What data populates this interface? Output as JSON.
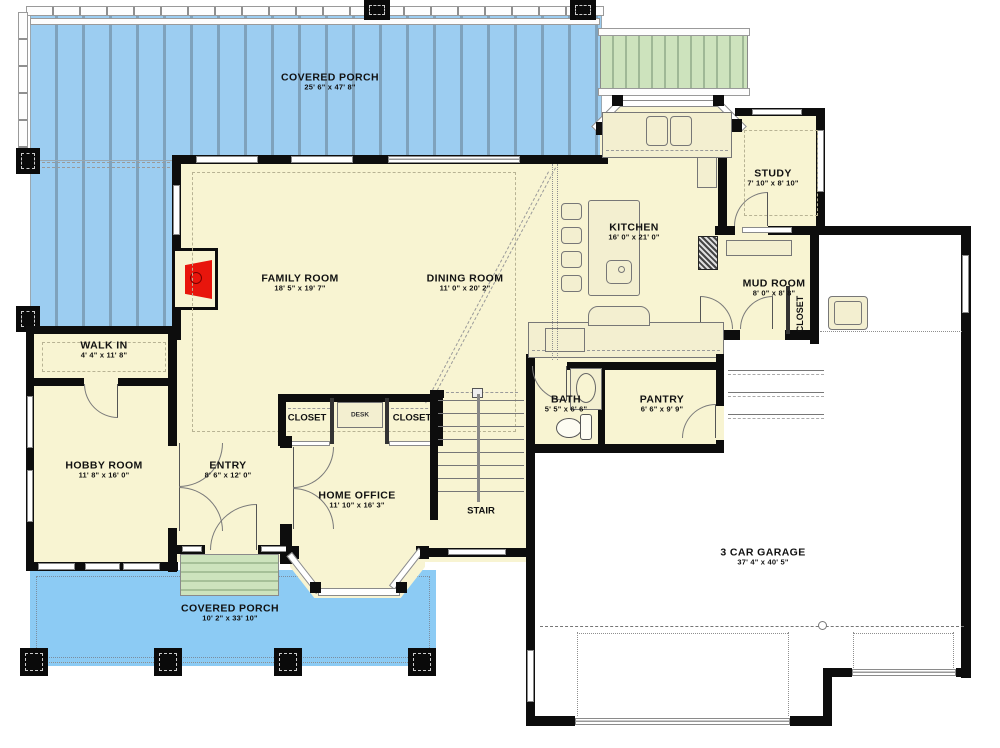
{
  "plan": {
    "title": "First floor plan",
    "rooms": [
      {
        "id": "covered-porch-top",
        "name": "COVERED PORCH",
        "dims": "25' 6\" x 47' 8\""
      },
      {
        "id": "study",
        "name": "STUDY",
        "dims": "7' 10\" x 8' 10\""
      },
      {
        "id": "kitchen",
        "name": "KITCHEN",
        "dims": "16' 0\" x 21' 0\""
      },
      {
        "id": "family-room",
        "name": "FAMILY ROOM",
        "dims": "18' 5\" x 19' 7\""
      },
      {
        "id": "dining-room",
        "name": "DINING ROOM",
        "dims": "11' 0\" x 20' 2\""
      },
      {
        "id": "mud-room",
        "name": "MUD ROOM",
        "dims": "8' 0\" x 8' 8\""
      },
      {
        "id": "walk-in",
        "name": "WALK IN",
        "dims": "4' 4\" x 11' 8\""
      },
      {
        "id": "hobby-room",
        "name": "HOBBY ROOM",
        "dims": "11' 8\" x 16' 0\""
      },
      {
        "id": "entry",
        "name": "ENTRY",
        "dims": "8' 6\" x 12' 0\""
      },
      {
        "id": "bath",
        "name": "BATH",
        "dims": "5' 5\" x 6' 6\""
      },
      {
        "id": "pantry",
        "name": "PANTRY",
        "dims": "6' 6\" x 9' 9\""
      },
      {
        "id": "home-office",
        "name": "HOME OFFICE",
        "dims": "11' 10\" x 16' 3\""
      },
      {
        "id": "garage",
        "name": "3 CAR GARAGE",
        "dims": "37' 4\" x 40' 5\""
      },
      {
        "id": "covered-porch-bottom",
        "name": "COVERED PORCH",
        "dims": "10' 2\" x 33' 10\""
      }
    ],
    "annotations": {
      "stair": "STAIR",
      "desk": "DESK",
      "closet": "CLOSET"
    },
    "colors": {
      "deck_blue": "#9ccdf1",
      "porch_blue": "#8ccbf4",
      "floor_cream": "#f8f4d2",
      "steps_green": "#cde3bd",
      "fireplace_red": "#e8150c",
      "wall_black": "#0d0d0d"
    }
  }
}
